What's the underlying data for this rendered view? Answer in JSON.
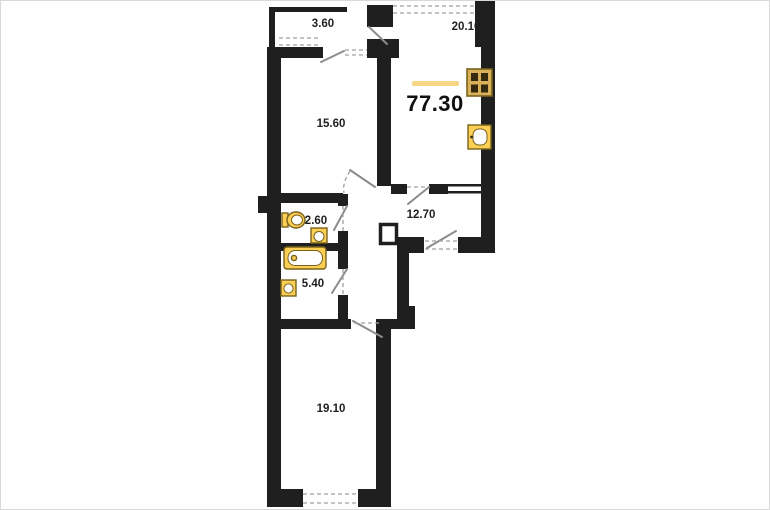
{
  "plan": {
    "total_area": "77.30",
    "rooms": {
      "balcony": "3.60",
      "kitchen_living": "20.10",
      "bedroom": "15.60",
      "hallway": "12.70",
      "wc": "2.60",
      "bathroom": "5.40",
      "bedroom2": "19.10"
    },
    "fixtures": [
      "stove-icon",
      "kitchen-sink-icon",
      "toilet-icon",
      "washbasin-icon",
      "bathtub-icon",
      "washbasin-2-icon"
    ],
    "colors": {
      "wall": "#1f1f1f",
      "door": "#8c8c8c",
      "dash": "#a0a0a0",
      "fixture_fill": "#fbce54",
      "fixture_stroke": "#7a621c",
      "stove_fill": "#d8b159",
      "stove_cell": "#352a10",
      "accent_line": "#f6d583",
      "label": "#1f1f1f"
    }
  }
}
